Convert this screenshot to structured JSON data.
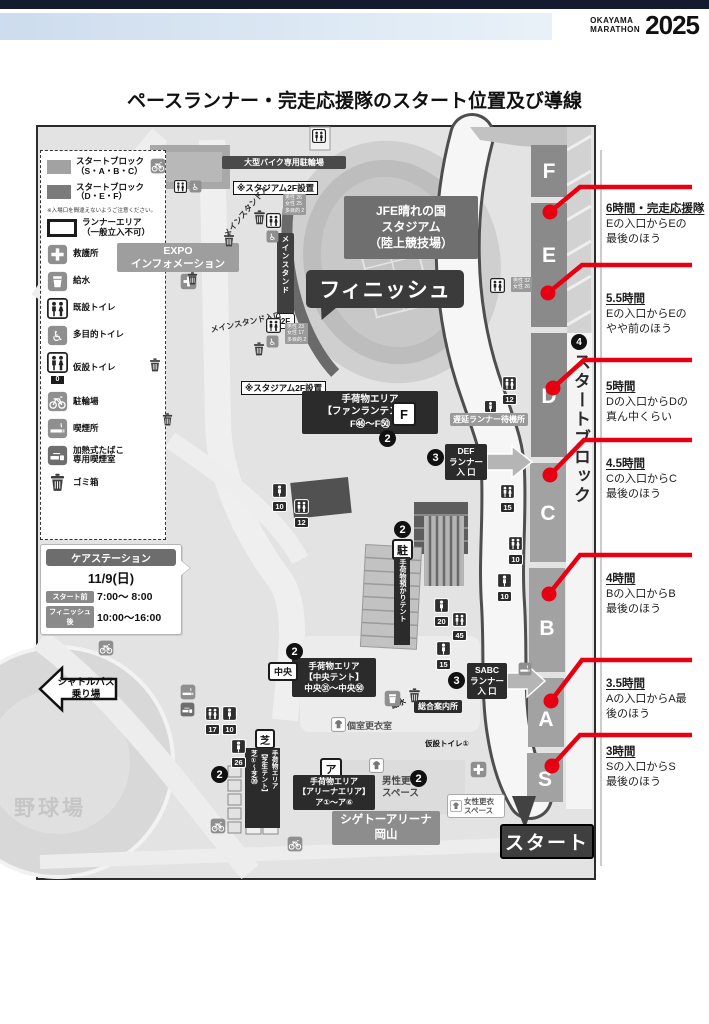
{
  "header": {
    "brand_line1": "OKAYAMA",
    "brand_line2": "MARATHON",
    "brand_year": "2025"
  },
  "page_title": "ペースランナー・完走応援隊のスタート位置及び導線",
  "colors": {
    "accent_red": "#e60012",
    "block_dark": "#8a8a8a",
    "block_light": "#a2a2a2"
  },
  "legend": {
    "items": [
      {
        "label": "スタートブロック\n（S・A・B・C）"
      },
      {
        "label": "スタートブロック\n（D・E・F）"
      },
      {
        "label": "ランナーエリア\n（一般立入不可）"
      },
      {
        "label": "救護所"
      },
      {
        "label": "給水"
      },
      {
        "label": "既設トイレ"
      },
      {
        "label": "多目的トイレ"
      },
      {
        "label": "仮設トイレ"
      },
      {
        "label": "駐輪場"
      },
      {
        "label": "喫煙所"
      },
      {
        "label": "加熱式たばこ\n専用喫煙室"
      },
      {
        "label": "ゴミ箱"
      }
    ],
    "note": "※入場口を間違えないようご注意ください。",
    "temp_toilet_zero": "0"
  },
  "care_station": {
    "title": "ケアステーション",
    "date": "11/9(日)",
    "rows": [
      {
        "label": "スタート前",
        "time": "7:00～ 8:00"
      },
      {
        "label": "フィニッシュ後",
        "time": "10:00～16:00"
      }
    ]
  },
  "map": {
    "stadium": "JFE晴れの国\nスタジアム\n（陸上競技場）",
    "finish": "フィニッシュ",
    "start": "スタート",
    "bike_parking": "大型バイク専用駐輪場",
    "stadium_2f_note": "※スタジアム2F設置",
    "expo": "EXPO\nインフォメーション",
    "main_stand": "メインスタンド",
    "main_stand_2f": "2F",
    "main_stand_entrance_top": "メインスタンド入",
    "main_stand_entrance_bottom": "メインスタンド入口",
    "baggage_fanrun": "手荷物エリア\n【ファンランテント】\nF㊻～F㊿",
    "fanrun_mark": "F",
    "delay_runner": "遅延ランナー待機所",
    "def_entrance": "DEF\nランナー\n入 口",
    "sabc_entrance": "SABC\nランナー\n入 口",
    "baggage_central": "手荷物エリア\n【中央テント】\n中央㉛～中央㊿",
    "central_mark": "中央",
    "baggage_keep": "手荷物預かりテント",
    "parking_mark": "駐",
    "info_center": "総合案内所",
    "private_changing": "個室更衣室",
    "water_note": "給水",
    "temp_toilet_note": "仮設トイレ①",
    "baggage_lawn": "手荷物エリア\n【芝生テント】\n芝①～芝⑳",
    "lawn_mark": "芝",
    "baggage_arena": "手荷物エリア\n【アリーナエリア】\nア①～ア⑥",
    "arena_mark": "ア",
    "mens_changing": "男性更衣\nスペース",
    "womens_changing": "女性更衣\nスペース",
    "arena_name": "シゲトーアリーナ\n岡山",
    "shuttle": "シャトルバス\n乗り場",
    "baseball": "野球場",
    "start_block_label": "スタートブロック",
    "blocks": [
      "F",
      "E",
      "D",
      "C",
      "B",
      "A",
      "S"
    ],
    "markers": {
      "m2": "2",
      "m3": "3",
      "m4": "4"
    },
    "toilet_counts": [
      "12",
      "15",
      "10",
      "10",
      "20",
      "45",
      "15",
      "10",
      "12",
      "17",
      "10",
      "26"
    ],
    "toilet_detail_top": "男性 26\n女性 25\n多目的 2",
    "toilet_detail_bottom": "男性 23\n女性 17\n多目的 2",
    "toilet_detail_e": "男性 32\n女性 26"
  },
  "annotations": [
    {
      "time": "6時間・完走応援隊",
      "desc": "Eの入口からEの\n最後のほう"
    },
    {
      "time": "5.5時間",
      "desc": "Eの入口からEの\nやや前のほう"
    },
    {
      "time": "5時間",
      "desc": "Dの入口からDの\n真ん中くらい"
    },
    {
      "time": "4.5時間",
      "desc": "Cの入口からC\n最後のほう"
    },
    {
      "time": "4時間",
      "desc": "Bの入口からB\n最後のほう"
    },
    {
      "time": "3.5時間",
      "desc": "Aの入口からA最\n後のほう"
    },
    {
      "time": "3時間",
      "desc": "Sの入口からS\n最後のほう"
    }
  ]
}
